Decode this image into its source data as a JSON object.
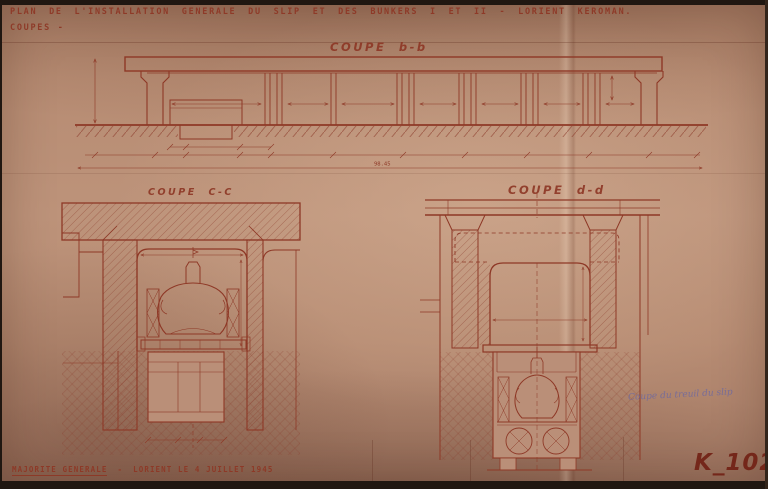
{
  "header": {
    "title": "PLAN DE L'INSTALLATION GENERALE DU SLIP ET DES BUNKERS I ET II - LORIENT KEROMAN.",
    "subtitle": "COUPES -"
  },
  "sections": {
    "bb": {
      "label": "COUPE b-b",
      "overall_dimension": "98.45"
    },
    "cc": {
      "label": "COUPE C-C"
    },
    "dd": {
      "label": "COUPE d-d"
    }
  },
  "annotations": {
    "handwritten_note": "Coupe du treuil du slip"
  },
  "footer": {
    "org": "MAJORITE GENERALE",
    "separator": "-",
    "place_date": "LORIENT LE 4 JUILLET 1945",
    "reference": "K_102"
  },
  "colors": {
    "paper": "#b98e74",
    "ink": "#8e3826",
    "ink_dark": "#732417",
    "note_ink": "#6a67a3",
    "photo_edge": "#201711"
  }
}
